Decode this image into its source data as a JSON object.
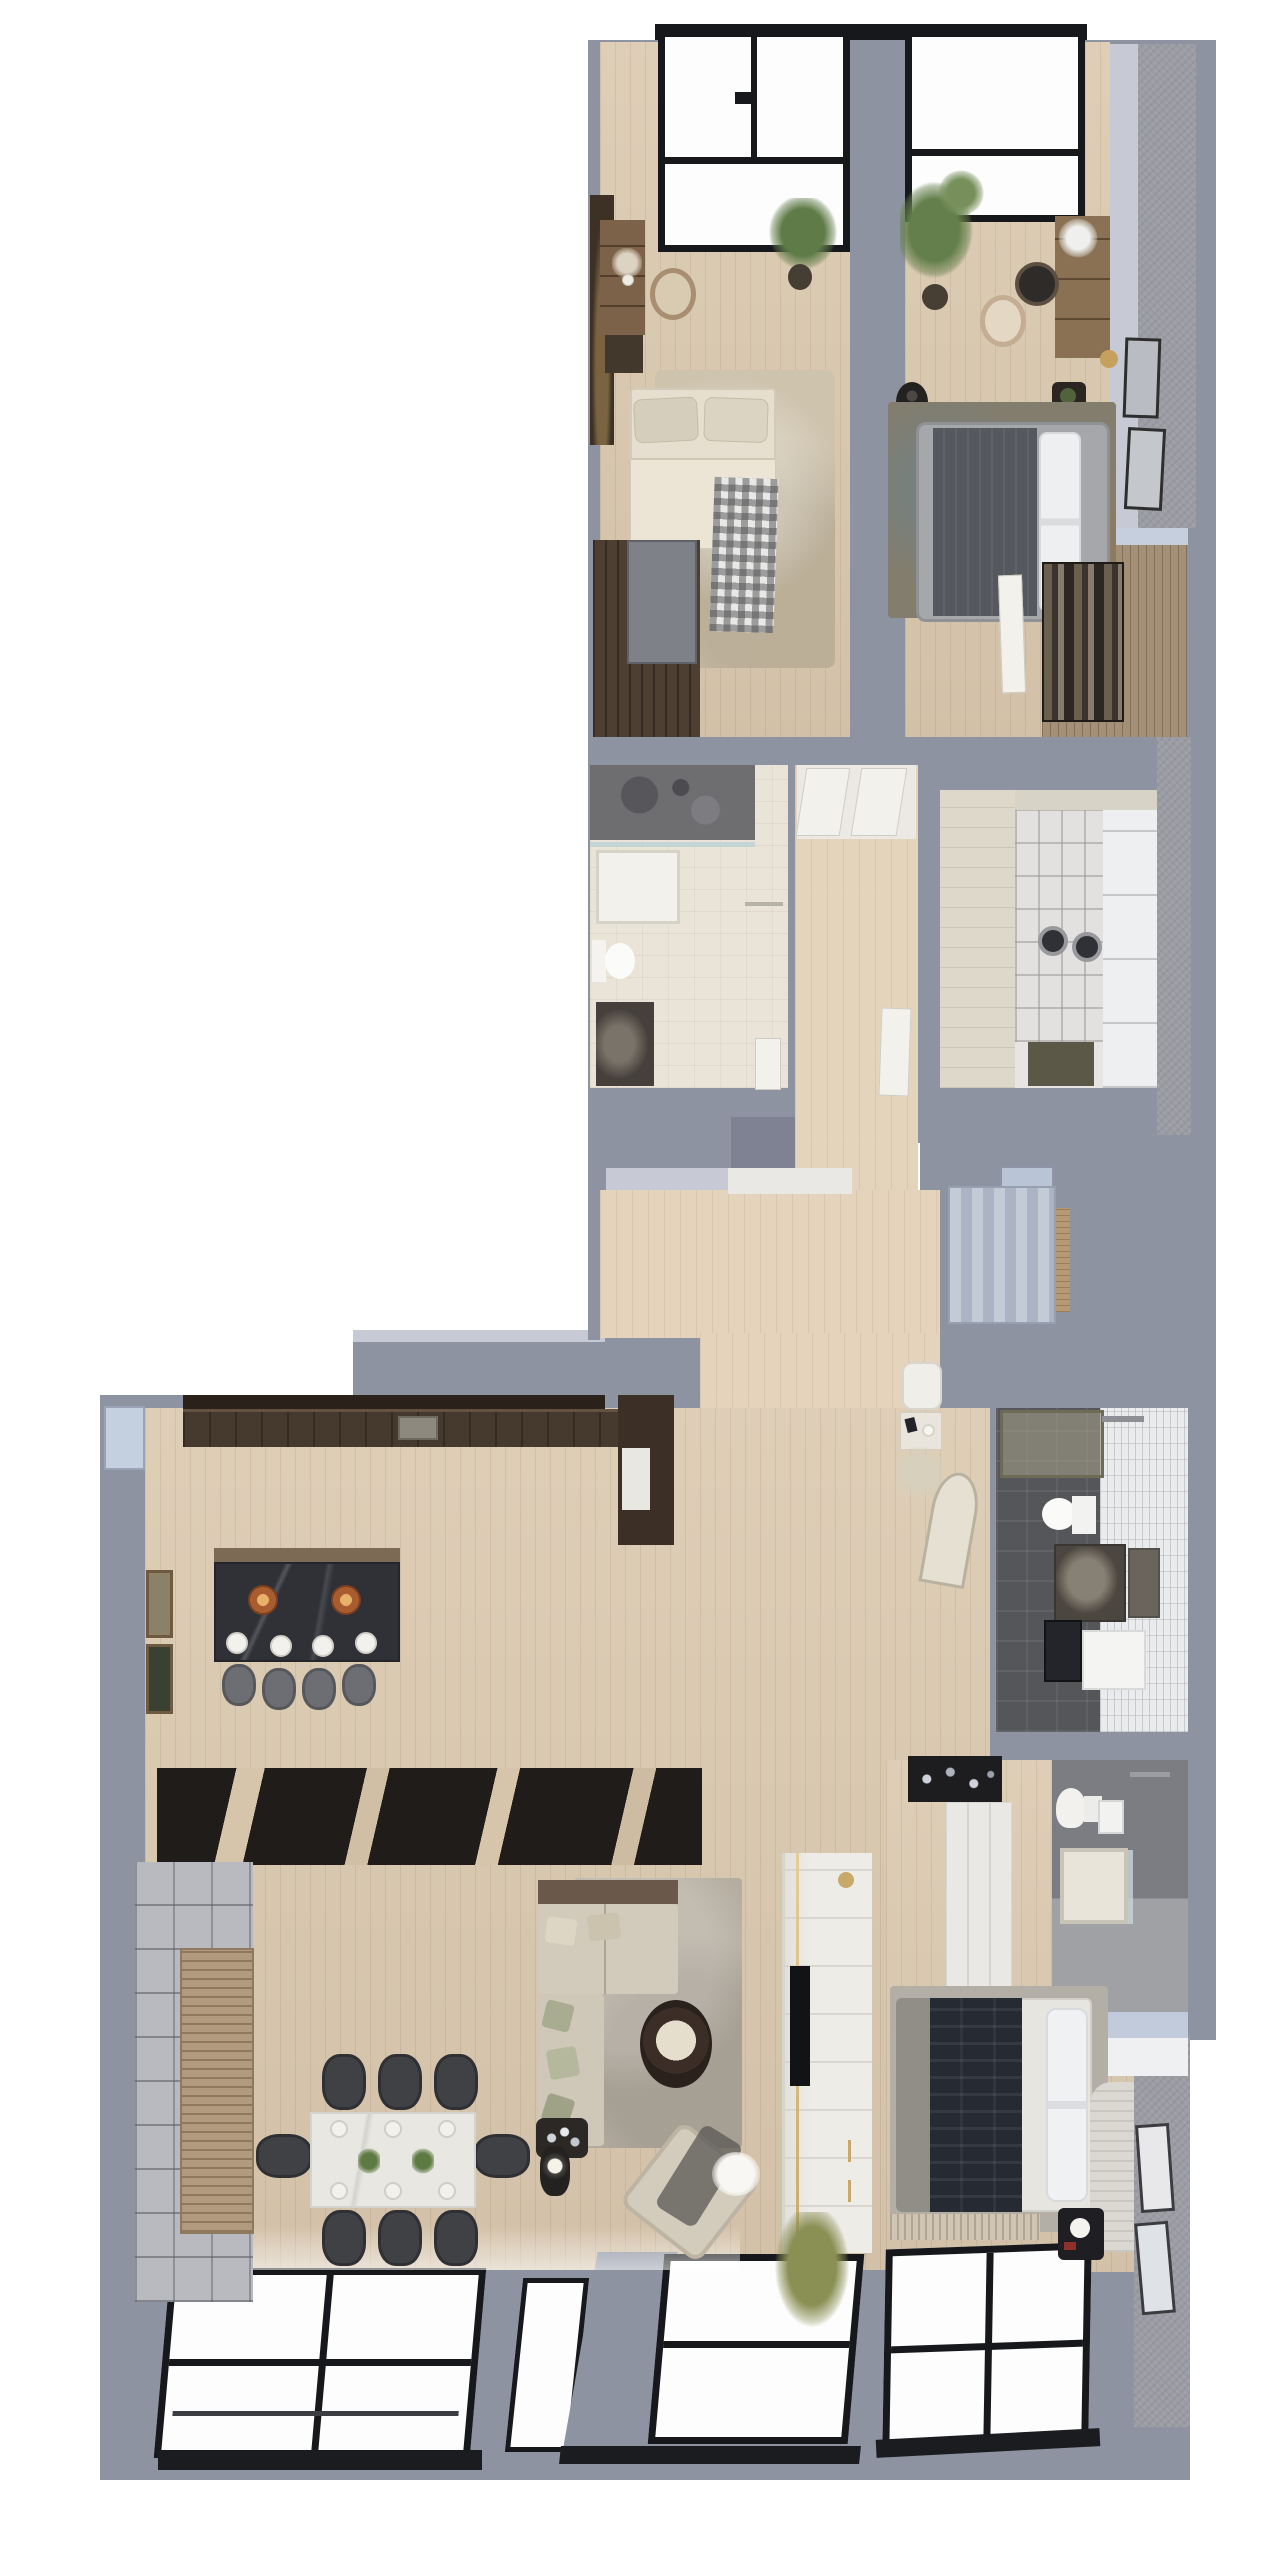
{
  "scene": {
    "title": "Apartment 3D floor plan — top-down render",
    "canvas": {
      "width": 1280,
      "height": 2560
    },
    "background": "#ffffff",
    "style": "photorealistic 3D architectural visualization, no text labels visible"
  },
  "palette": {
    "wall": "#8e93a2",
    "wall_highlight": "#c7cad5",
    "wall_textured": "#9b9ca4",
    "floor_wood": "#dbc9af",
    "floor_wood_warm": "#e4d4bc",
    "window_frame": "#17181c",
    "glass": "#fdfdfd",
    "glass_tint": "#c0cbdd",
    "marble_white": "#eae4d8",
    "stone_island": "#2f3137",
    "walnut_dark": "#3b2f26",
    "tile_graphite": "#54565a",
    "tile_white": "#e9ebec",
    "sofa_beige": "#d2cabb",
    "pillow_sage": "#a9ac90",
    "rug_gray": "#b5ada0",
    "bed_navy": "#262a33",
    "copper": "#b06a38",
    "gold": "#c9a96a",
    "plant_green": "#5f7b47",
    "plant_olive": "#8a8f54"
  },
  "apartment": {
    "rooms": [
      {
        "name": "Bedroom 1",
        "furniture": [
          "skylight window",
          "double bed with beige bedding",
          "checkered plaid throw",
          "area rug",
          "dresser with flower vase",
          "accent chair",
          "potted plant",
          "built-in wardrobe",
          "dark media sideboard"
        ]
      },
      {
        "name": "Bedroom 2",
        "furniture": [
          "skylight window",
          "upholstered bed with gray throw",
          "white pillows",
          "patterned rug",
          "vanity desk with flowers",
          "accent chair",
          "round wall mirror",
          "floor vase",
          "large potted plant",
          "two wall frames",
          "gold sconce",
          "white door"
        ]
      },
      {
        "name": "Walk-in closet",
        "furniture": [
          "slatted wardrobe",
          "open hanging rail with clothes",
          "glass partition band"
        ]
      },
      {
        "name": "Bathroom 1",
        "furniture": [
          "walk-in shower with stone wall",
          "glass screen",
          "shower tray",
          "toilet",
          "stone vanity",
          "towel rail",
          "door"
        ]
      },
      {
        "name": "Hallway",
        "furniture": [
          "wood plank flooring",
          "two open white doors",
          "white ceiling panel",
          "door to bedroom corridor"
        ]
      },
      {
        "name": "Laundry room",
        "furniture": [
          "washer",
          "dryer",
          "white linen shelving",
          "folded towels",
          "laundry basket",
          "marble wall band",
          "white tile wall"
        ]
      },
      {
        "name": "Entry",
        "furniture": [
          "striped doormat",
          "light-blue front door",
          "wood threshold",
          "bench pouf",
          "console with lamp and book",
          "dried plant",
          "leaning arched mirror"
        ]
      },
      {
        "name": "Kitchen",
        "furniture": [
          "wall counter with sink",
          "tall cabinet column with appliance",
          "stone kitchen island with breakfast bar",
          "two copper bowls",
          "four place settings",
          "four bar stools",
          "pendant lamps",
          "two wall artworks",
          "dark glossy floor inlay",
          "corner window"
        ]
      },
      {
        "name": "Dining area",
        "furniture": [
          "white marble dining table",
          "eight dark chairs",
          "six place settings",
          "greenery centerpiece"
        ]
      },
      {
        "name": "Living room",
        "furniture": [
          "L-shaped beige sofa",
          "sage and cream cushions",
          "shag rug",
          "round dark coffee table with tray",
          "rotated armchair with throw",
          "sheepskin",
          "side table with glassware",
          "black floor lamp",
          "bookshelf wall",
          "slatted wood sideboard",
          "white TV media wall with gold trim",
          "olive plant",
          "corner window wall"
        ]
      },
      {
        "name": "Bedroom 3",
        "furniture": [
          "bed with navy quilted throw",
          "white duvet and pillows",
          "curved ribbed headboard",
          "knit runner",
          "black nightstand with sphere lamp",
          "black dresser with glass decor",
          "built-in white wardrobe",
          "two gallery frames",
          "corner window"
        ]
      },
      {
        "name": "Bathroom 2",
        "furniture": [
          "glass shower enclosure",
          "rain shower bar",
          "toilet",
          "stone vanity",
          "mirror",
          "white storage cabinet",
          "black appliance",
          "graphite tile floor",
          "white tile wall"
        ]
      },
      {
        "name": "Bathroom 3",
        "furniture": [
          "toilet",
          "wall-hung basin",
          "marble shower tray",
          "glass screen",
          "towel bar"
        ]
      }
    ]
  }
}
